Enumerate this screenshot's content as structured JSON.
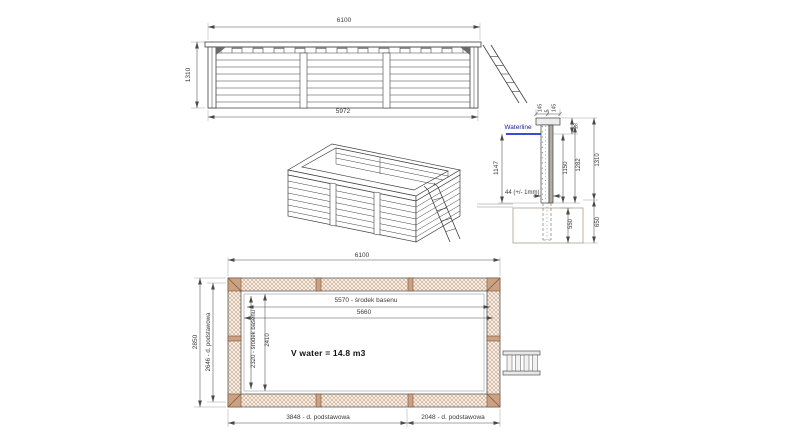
{
  "page": {
    "background": "#ffffff"
  },
  "colors": {
    "line": "#3f3f3f",
    "dim_line": "#4a4a4a",
    "waterline_blue": "#2233cc",
    "wood_hatch": "#c49a7a",
    "wood_block": "#caa183"
  },
  "elevation_view": {
    "dim_width_top": "6100",
    "dim_height_left": "1310",
    "dim_width_bottom": "5972"
  },
  "section_view": {
    "waterline_label": "Waterline",
    "dim_cap_left": "145",
    "dim_cap_middle": "5",
    "dim_cap_right": "145",
    "dim_freeboard": "28",
    "dim_water_depth": "1147",
    "dim_wall_note": "44 (+/- 1mm)",
    "dim_inner_height": "1150",
    "dim_outer_height": "1282",
    "dim_total_height": "1310",
    "dim_below_ground": "550",
    "dim_foundation_depth": "650"
  },
  "plan_view": {
    "dim_width_top": "6100",
    "dim_height_outer": "2850",
    "dim_height_base": "2646 - d. podstawowa",
    "dim_length_center": "5570 - środek basenu",
    "dim_length_inner": "5660",
    "dim_width_center": "2320 - środek basenu",
    "dim_width_inner": "2410",
    "volume_note": "V water = 14.8 m3",
    "dim_base_left": "3848 - d. podstawowa",
    "dim_base_right": "2048 - d. podstawowa"
  }
}
